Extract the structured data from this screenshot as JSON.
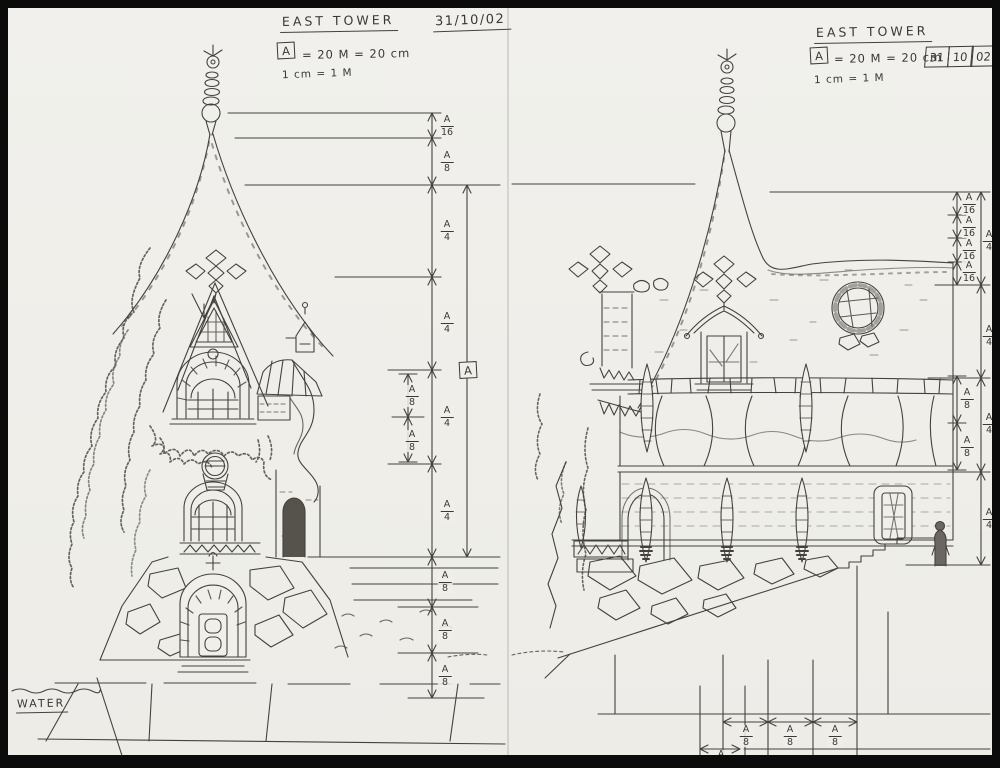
{
  "colors": {
    "paper": "#f0efea",
    "ink": "#44413c",
    "border": "#0b0b0b"
  },
  "sheet_left": {
    "title": "EAST TOWER",
    "date": "31/10/02",
    "scale": {
      "box_letter": "A",
      "equation": "= 20 M = 20 cm",
      "note": "1 cm = 1 M"
    },
    "reference_letter": "A",
    "water_label": "WATER",
    "dims_outer": [
      {
        "num": "A",
        "den": "16"
      },
      {
        "num": "A",
        "den": "8"
      },
      {
        "num": "A",
        "den": "4"
      },
      {
        "num": "A",
        "den": "4"
      },
      {
        "num": "A",
        "den": "4"
      },
      {
        "num": "A",
        "den": "4"
      },
      {
        "num": "A",
        "den": "8"
      },
      {
        "num": "A",
        "den": "8"
      },
      {
        "num": "A",
        "den": "8"
      }
    ],
    "dims_inner": [
      {
        "num": "A",
        "den": "8"
      },
      {
        "num": "A",
        "den": "8"
      }
    ]
  },
  "sheet_right": {
    "title": "EAST TOWER",
    "scale": {
      "box_letter": "A",
      "equation": "= 20 M = 20 cm",
      "note": "1 cm = 1 M"
    },
    "date_cells": [
      "31",
      "10",
      "02"
    ],
    "col_inner": [
      {
        "num": "A",
        "den": "16"
      },
      {
        "num": "A",
        "den": "16"
      },
      {
        "num": "A",
        "den": "16"
      },
      {
        "num": "A",
        "den": "16"
      },
      {
        "num": "A",
        "den": "8"
      },
      {
        "num": "A",
        "den": "8"
      }
    ],
    "col_outer": [
      {
        "num": "A",
        "den": "4"
      },
      {
        "num": "A",
        "den": "4"
      },
      {
        "num": "A",
        "den": "4"
      },
      {
        "num": "A",
        "den": "4"
      }
    ],
    "bottom": [
      {
        "num": "A",
        "den": "8"
      },
      {
        "num": "A",
        "den": "8"
      },
      {
        "num": "A",
        "den": "8"
      }
    ],
    "bottom_left": {
      "num": "A",
      "den": "8"
    }
  }
}
